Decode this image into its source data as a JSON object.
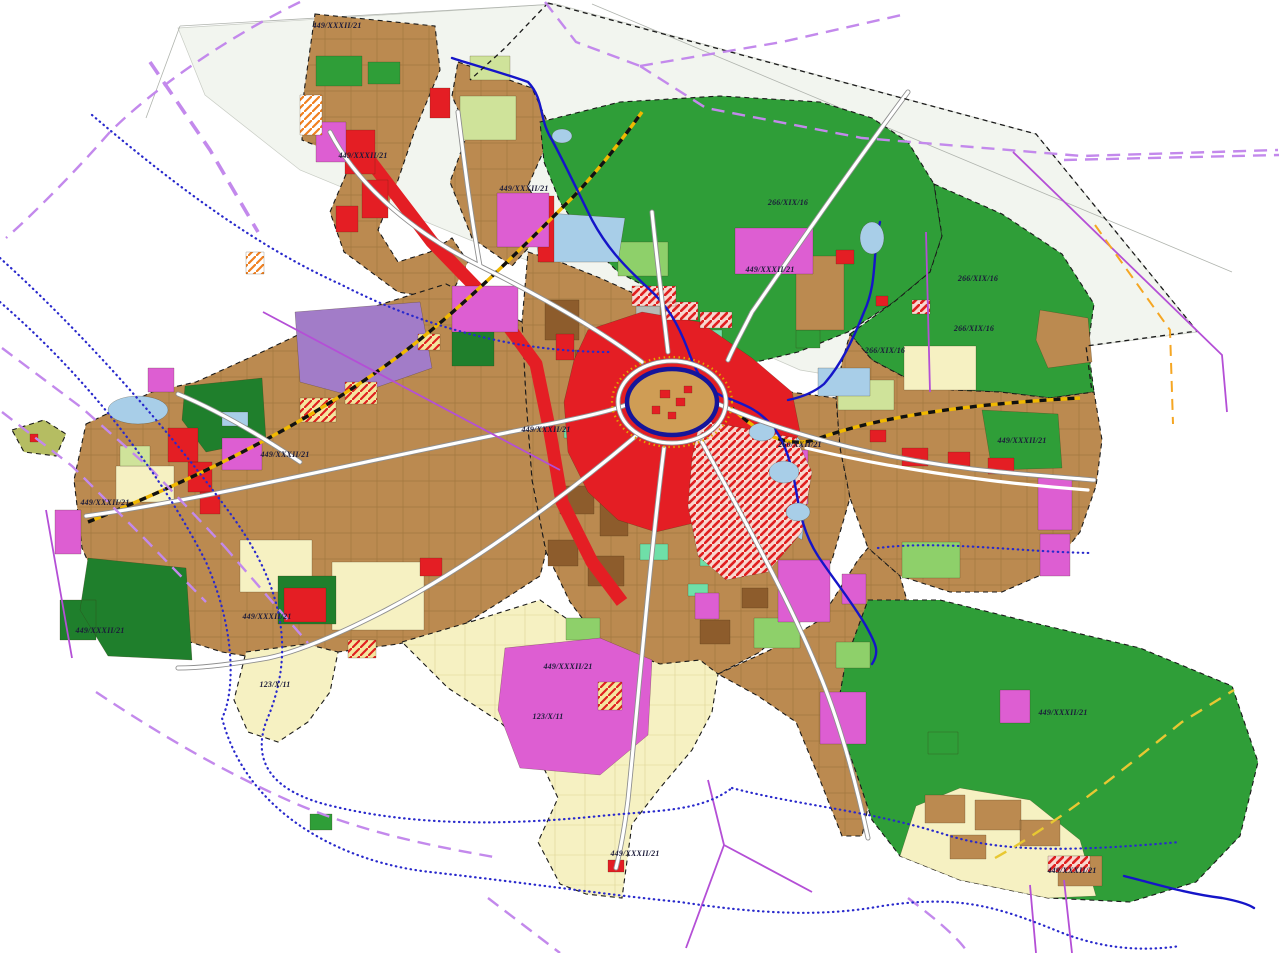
{
  "map": {
    "background": "#ffffff",
    "labels": [
      {
        "text": "449/XXXII/21",
        "x": 337,
        "y": 28
      },
      {
        "text": "449/XXXII/21",
        "x": 363,
        "y": 158
      },
      {
        "text": "449/XXXII/21",
        "x": 524,
        "y": 191
      },
      {
        "text": "266/XIX/16",
        "x": 788,
        "y": 205
      },
      {
        "text": "449/XXXII/21",
        "x": 770,
        "y": 272
      },
      {
        "text": "266/XIX/16",
        "x": 978,
        "y": 281
      },
      {
        "text": "266/XIX/16",
        "x": 974,
        "y": 331
      },
      {
        "text": "266/XIX/16",
        "x": 885,
        "y": 353
      },
      {
        "text": "449/XXXII/21",
        "x": 546,
        "y": 432
      },
      {
        "text": "260/XXII/21",
        "x": 800,
        "y": 447
      },
      {
        "text": "449/XXXII/21",
        "x": 1022,
        "y": 443
      },
      {
        "text": "449/XXXII/21",
        "x": 285,
        "y": 457
      },
      {
        "text": "449/XXXII/21",
        "x": 105,
        "y": 505
      },
      {
        "text": "449/XXXII/21",
        "x": 267,
        "y": 619
      },
      {
        "text": "449/XXXII/21",
        "x": 100,
        "y": 633
      },
      {
        "text": "123/X/11",
        "x": 275,
        "y": 687
      },
      {
        "text": "449/XXXII/21",
        "x": 568,
        "y": 669
      },
      {
        "text": "123/X/11",
        "x": 548,
        "y": 719
      },
      {
        "text": "449/XXXII/21",
        "x": 635,
        "y": 856
      },
      {
        "text": "449/XXXII/21",
        "x": 1063,
        "y": 715
      },
      {
        "text": "449/XXXII/21",
        "x": 1072,
        "y": 873
      }
    ],
    "palette": {
      "forest_green": "#2f9e38",
      "forest_dark": "#1f7f2c",
      "urban_tan": "#bb8a50",
      "urban_grid_line": "#99713a",
      "dark_brown": "#8d5c2c",
      "service_red": "#e41e24",
      "production_magenta": "#dd5ed2",
      "special_purple": "#a27cc8",
      "agriculture_cream": "#f6f1c2",
      "cream_grid_line": "#d8cc8a",
      "meadow_lightgreen": "#8ed06a",
      "meadow_palegreen": "#cfe39a",
      "park_mint": "#6fdfa8",
      "water_lightblue": "#a8cee8",
      "water_navy": "#1515c8",
      "grey_area": "#b7bab6",
      "road_white": "#ffffff",
      "road_casing": "#8f8f8f",
      "oldtown_ring_navy": "#15159a",
      "oldtown_fill": "#cf9d55",
      "oldtown_gold": "#e0a500",
      "boundary_black": "#1a1a1a",
      "admin_violet_dashed": "#c389ec",
      "admin_purple_solid": "#b44fd6",
      "infra_blue_dotted": "#2929cc",
      "rail_yellow": "#f0b800",
      "gas_orange_dashed": "#f5a623",
      "hatch_red_bg": "#f8d8d0",
      "hatch_yellow_bg": "#f5e6a0",
      "tint_bg": "#f2f5ef",
      "label_ink": "#1b1b3a"
    },
    "line_layers": [
      "city-limit-black-dashed",
      "admin-boundary-violet-dashed",
      "admin-boundary-purple-solid",
      "infrastructure-blue-dotted",
      "infrastructure-orange-dashed",
      "railway-black-yellow",
      "river-navy",
      "road-white",
      "old-town-ring-navy"
    ]
  }
}
